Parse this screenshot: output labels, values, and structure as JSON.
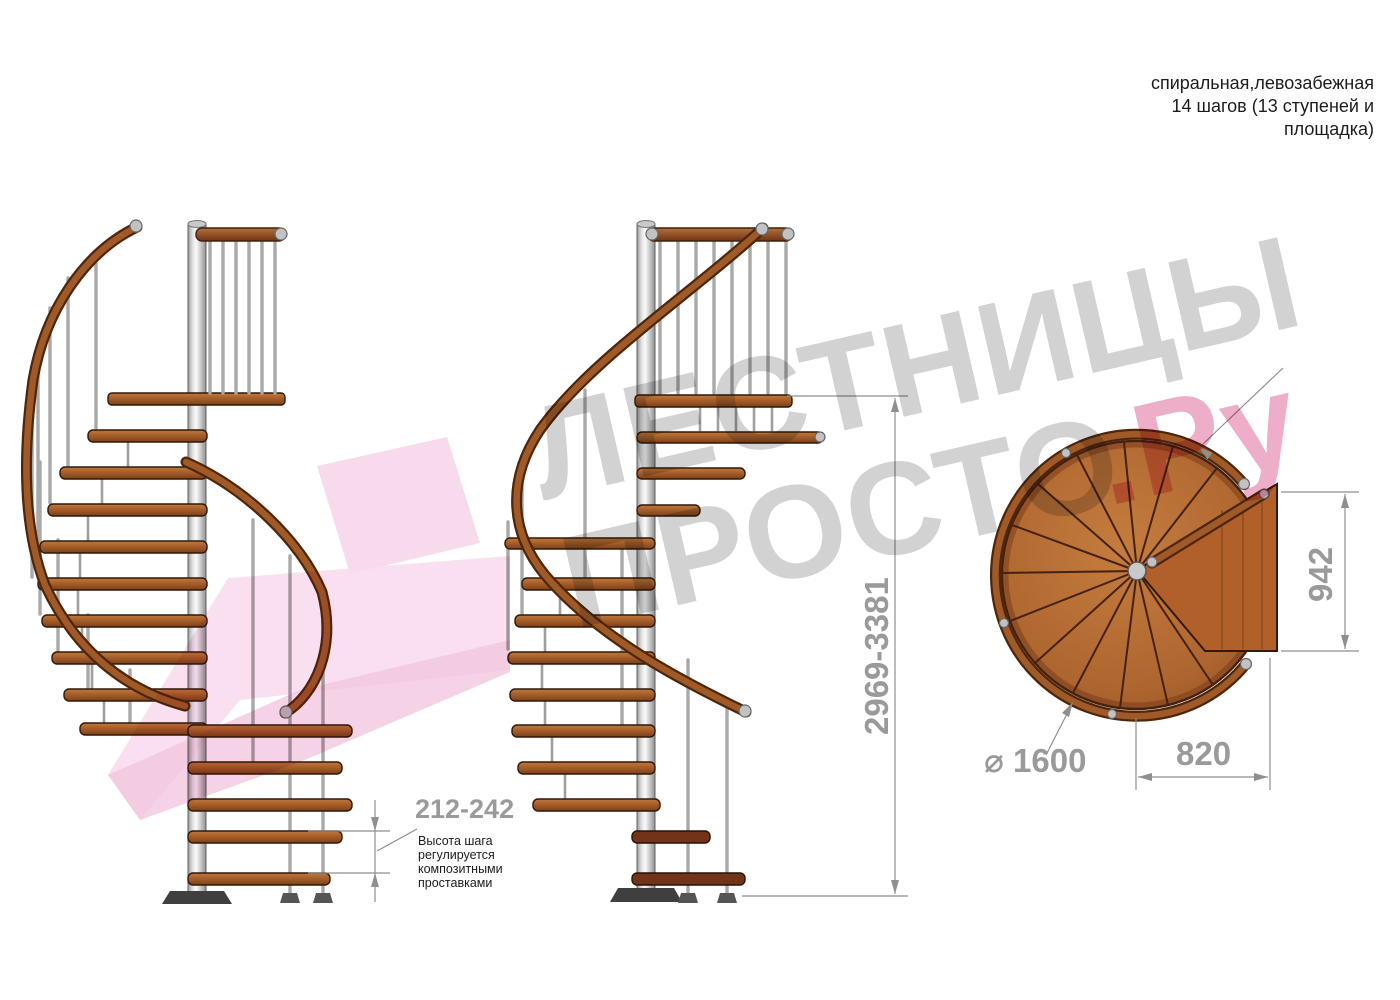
{
  "title": {
    "line1": "спиральная,левозабежная",
    "line2": "14 шагов (13 ступеней и",
    "line3": "площадка)"
  },
  "dimensions": {
    "total_height": "2969-3381",
    "step_rise": "212-242",
    "diameter": "⌀ 1600",
    "passage_width": "820",
    "platform_depth": "942"
  },
  "annotation": {
    "line1": "Высота шага",
    "line2": "регулируется",
    "line3": "композитными",
    "line4": "проставками"
  },
  "watermark": {
    "word1": "ЛЕСТНИЦЫ",
    "word2": "ПРОСТО",
    "word3": ".Ру"
  },
  "colors": {
    "wood": "#b06a33",
    "wood_dark": "#713419",
    "rail": "#8c4a20",
    "pole": "#d9d9d9",
    "dim_gray": "#9a9a9a",
    "watermark_gray": "#d2d2d2",
    "watermark_pink": "#eeadc8",
    "watermark_arrow_pink": "#f6d3e7",
    "background": "#ffffff"
  }
}
